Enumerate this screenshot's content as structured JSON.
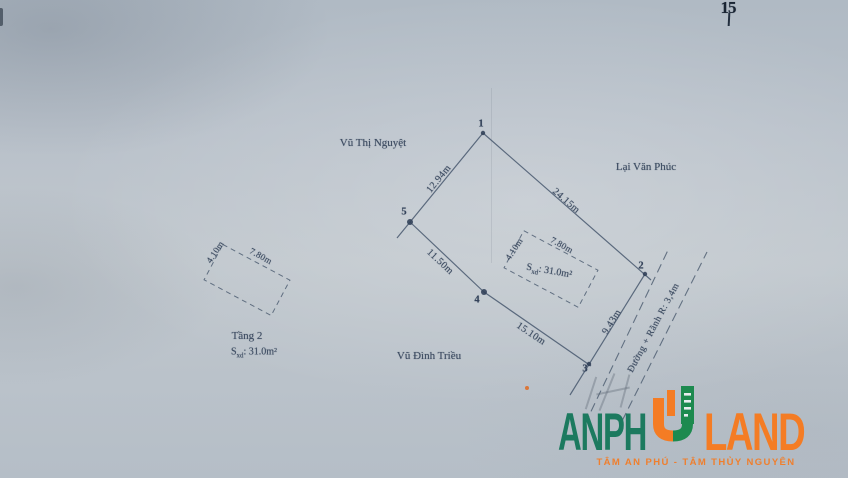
{
  "scan": {
    "page_mark": "15"
  },
  "parcel": {
    "owner_top": "Vũ Thị Nguyệt",
    "owner_right": "Lại Văn Phúc",
    "owner_bottom": "Vũ Đình Triều",
    "points": {
      "p1": "1",
      "p2": "2",
      "p3": "3",
      "p4": "4",
      "p5": "5"
    },
    "edges": {
      "e_1_5": "12.94m",
      "e_1_2": "24.15m",
      "e_5_4": "11.50m",
      "e_4_3": "15.10m",
      "e_3_2": "9.43m"
    },
    "building": {
      "side_short": "4.10m",
      "side_long": "7.80m",
      "area_s": "S",
      "area_sub": "xd",
      "area_rest": ": 31.0m²"
    },
    "floor2": {
      "title": "Tầng 2",
      "side_short": "4.10m",
      "side_long": "7.80m",
      "area_s": "S",
      "area_sub": "xd",
      "area_rest": ": 31.0m²"
    },
    "road_label": "Đường + Rãnh R: 3,4m"
  },
  "branding": {
    "logo_part1": "ANPH",
    "logo_part2": "LAND",
    "tagline": "TÂM AN PHÚ - TÂM THỦY NGUYÊN",
    "color_green": "#1c7a5f",
    "color_orange": "#f47c24",
    "ink_color": "#3d4c62"
  }
}
